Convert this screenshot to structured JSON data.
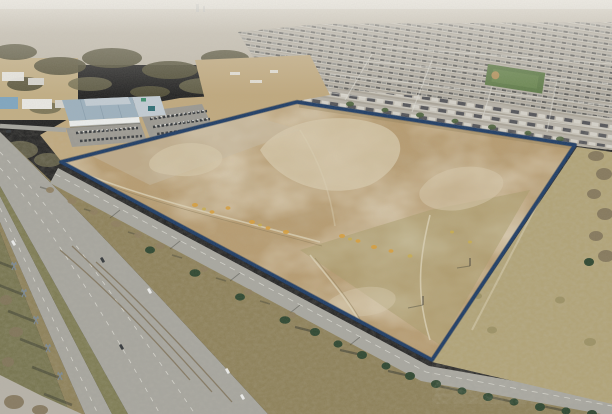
{
  "meta": {
    "title": "Aerial drone photograph of a vacant development parcel outlined with a navy property boundary",
    "width": 612,
    "height": 414
  },
  "scene": {
    "boundary_label": "property-boundary-outline",
    "subject": "vacant land parcel",
    "surroundings": "highway, commercial building, suburban homes",
    "regions": "sky, distant city, suburbs, sports field, commercial building, parking, divided highway, transmission towers, tree rows, service road, vacant parcel, grass field"
  },
  "colors": {
    "skyTop": "#e0ded8",
    "skyBottom": "#cfccc2",
    "haze": "#e9e6df",
    "farCity": "#bfb8aa",
    "farCityShade": "#a79e8b",
    "farTreeBrown": "#8c8168",
    "towerDistant": "#9aa0a4",
    "treeDark": "#55523a",
    "treeMid": "#6e6a4e",
    "treeBrown": "#82755a",
    "fieldTan": "#c2ae84",
    "constructionTan": "#c0a97e",
    "warehouseWhite": "#e9e8e4",
    "warehouseBlue": "#7fa6c0",
    "shedGray": "#d6d4cd",
    "roofBlue": "#9db1bf",
    "roofBlueLight": "#c2ccd4",
    "roofSeam": "#8096a6",
    "facadeWhite": "#eceeed",
    "teal": "#2f6f76",
    "tealGreen": "#3f8f6e",
    "parking": "#9b9992",
    "carDark": "#33373b",
    "carWhite": "#ecedec",
    "asphalt": "#a6a59e",
    "laneWhite": "#e2e1da",
    "medianGrass": "#7d7b52",
    "brushBrown": "#8d8058",
    "rutBrown": "#6e5c3c",
    "verge": "#76744e",
    "towerSteel": "#7d8a94",
    "shadowDark": "#31342c",
    "conifer": "#2e4730",
    "coniferLight": "#49613a",
    "bareTree": "#8f7f60",
    "boundaryRoad": "#a8a7a0",
    "navy": "#1d3c66",
    "navyShadow": "#14294a",
    "parcelBase": "#b79c71",
    "parcelLight": "#d7c9ac",
    "parcelGray": "#c7bda6",
    "parcelDark": "#9f8a5f",
    "parcelOlive": "#a89b6a",
    "trackLight": "#dcd2b6",
    "trackDark": "#8d7b57",
    "shrubOrange": "#d89f3c",
    "shrubYellow": "#c9ae4d",
    "fieldRight": "#b1a376",
    "fieldRightDark": "#9a8f62",
    "street": "#b7b2a8",
    "roofDark1": "#5c5c5a",
    "roofMid1": "#90908c",
    "wallLight": "#cbc7bd",
    "yard": "#aaa498",
    "roofNearDark": "#54555a",
    "roofNearLight": "#d5d2ca",
    "parkGreen": "#5e7b48",
    "parkGreenLight": "#6f8c55",
    "dirtSpot": "#b3925d"
  }
}
